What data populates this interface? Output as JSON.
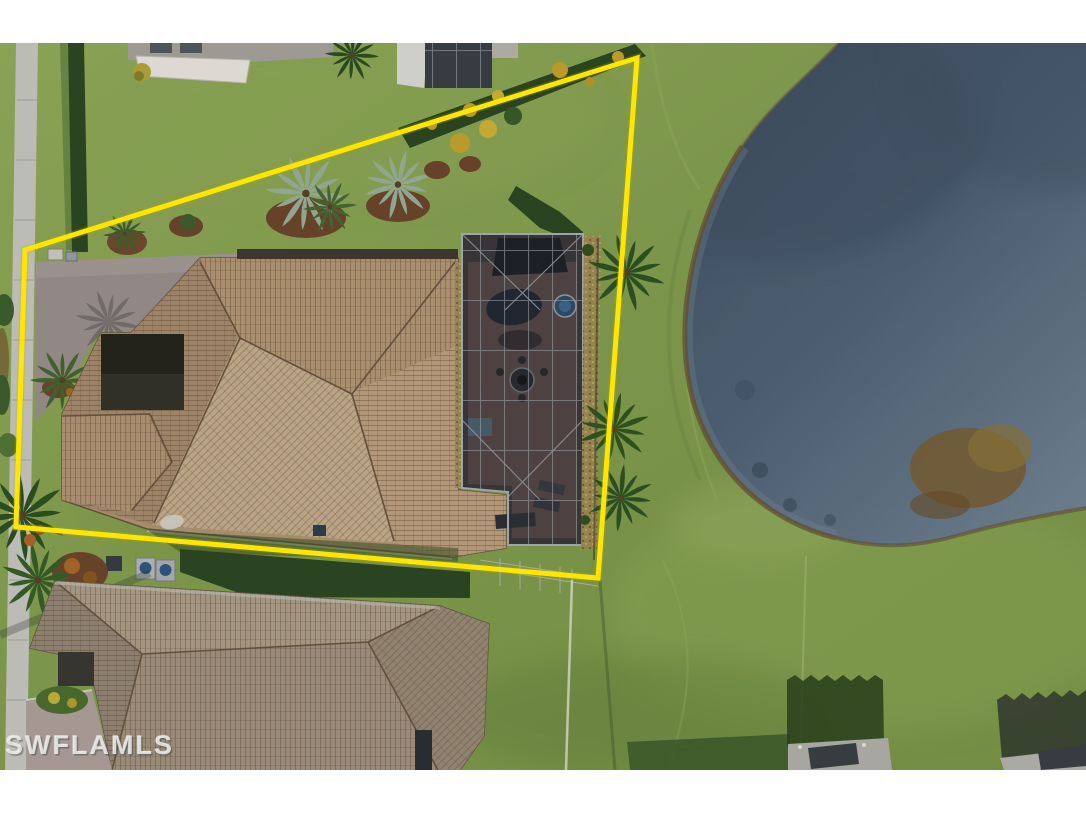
{
  "watermark": {
    "text": "SWFLAMLS"
  },
  "scene": {
    "type": "aerial-drone-photo",
    "subject": "Lakefront single-family home lot outlined with a yellow property-boundary overlay; tile-roof houses, pool screen enclosure, palms, sidewalk and pond",
    "colors": {
      "page-bg": "#ffffff",
      "boundary-yellow": "#ffe600",
      "grass-base": "#85a150",
      "grass-light": "#95af5c",
      "grass-dark": "#5e7d3c",
      "lake-deep": "#4e6076",
      "lake-mid": "#667b91",
      "lake-shallow": "#8599ab",
      "shore-sand": "#8a6b3a",
      "roof-main": "#b49775",
      "roof-main-light": "#c9b190",
      "roof-neighbor": "#a6968a",
      "pool-cage": "#3e3a3b",
      "cage-frame": "#9aa1a8",
      "driveway": "#9c928f",
      "sidewalk": "#cbcbc5",
      "hedge-green": "#2e4a24",
      "gold-shrub": "#c9a531",
      "mulch-brown": "#754b30",
      "palm-green": "#35572a",
      "palm-silver": "#9db39a",
      "watermark-color": "rgba(244,244,242,0.8)"
    }
  }
}
